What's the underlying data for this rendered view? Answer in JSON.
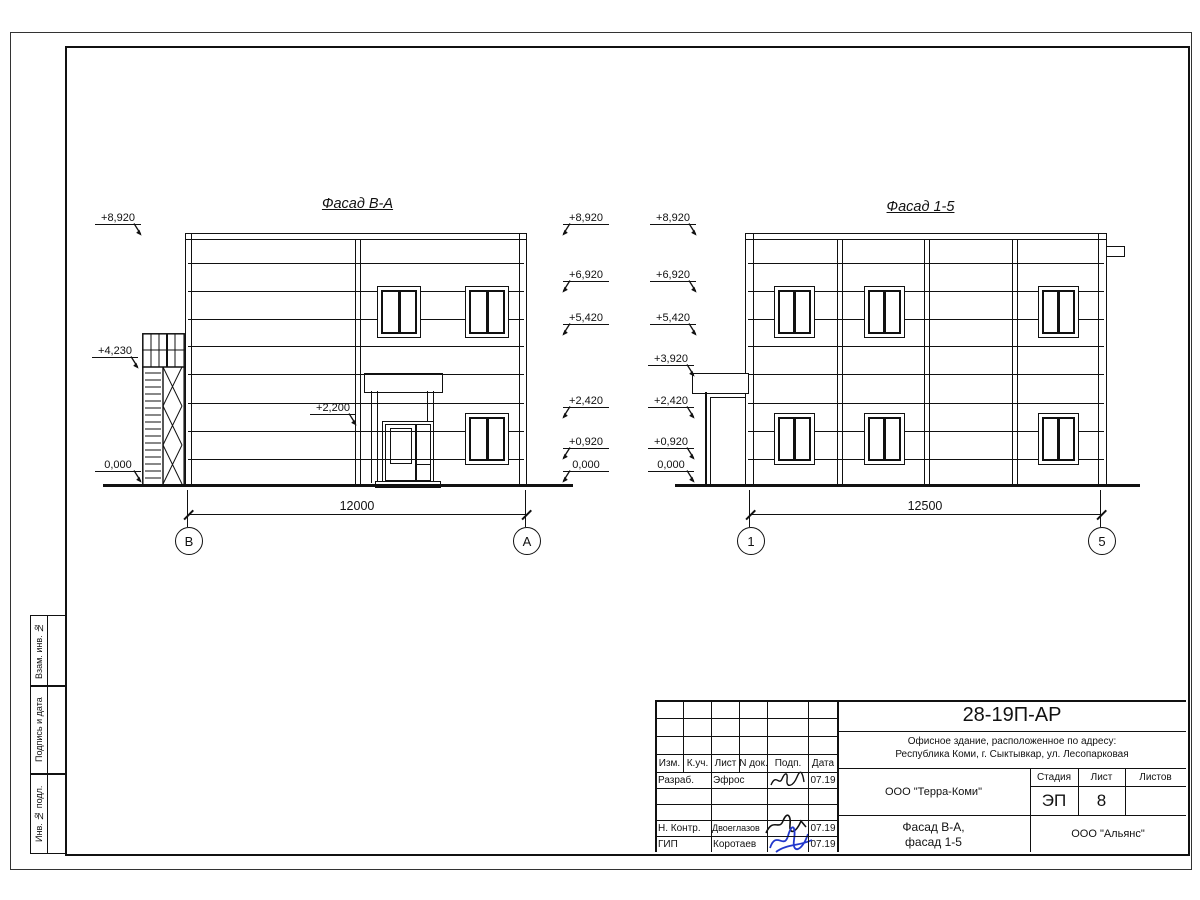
{
  "frame": {
    "side_labels": [
      "Взам. инв. №",
      "Подпись и дата",
      "Инв. № подл."
    ]
  },
  "facade_ba": {
    "title": "Фасад В-А",
    "dimension": "12000",
    "axis_left": "В",
    "axis_right": "А",
    "marks_left": [
      "+8,920",
      "+4,230",
      "0,000"
    ],
    "mark_entry": "+2,200",
    "marks_right": [
      "+8,920",
      "+6,920",
      "+5,420",
      "+2,420",
      "+0,920",
      "0,000"
    ]
  },
  "facade_15": {
    "title": "Фасад 1-5",
    "dimension": "12500",
    "axis_left": "1",
    "axis_right": "5",
    "marks_left": [
      "+8,920",
      "+6,920",
      "+5,420",
      "+3,920",
      "+2,420",
      "+0,920",
      "0,000"
    ]
  },
  "title_block": {
    "doc_number": "28-19П-АР",
    "description_line1": "Офисное здание, расположенное по адресу:",
    "description_line2": "Республика Коми, г. Сыктывкар, ул. Лесопарковая",
    "columns": [
      "Изм.",
      "К.уч.",
      "Лист",
      "N док.",
      "Подп.",
      "Дата"
    ],
    "rows": [
      {
        "role": "Разраб.",
        "name": "Эфрос",
        "date": "07.19"
      },
      {
        "role": "Н. Контр.",
        "name": "Двоеглазов",
        "date": "07.19"
      },
      {
        "role": "ГИП",
        "name": "Коротаев",
        "date": "07.19"
      }
    ],
    "client": "ООО \"Терра-Коми\"",
    "stage_label": "Стадия",
    "sheet_label": "Лист",
    "sheets_label": "Листов",
    "stage": "ЭП",
    "sheet_number": "8",
    "sheets_total": "",
    "sheet_title_line1": "Фасад В-А,",
    "sheet_title_line2": "фасад 1-5",
    "contractor": "ООО \"Альянс\""
  }
}
